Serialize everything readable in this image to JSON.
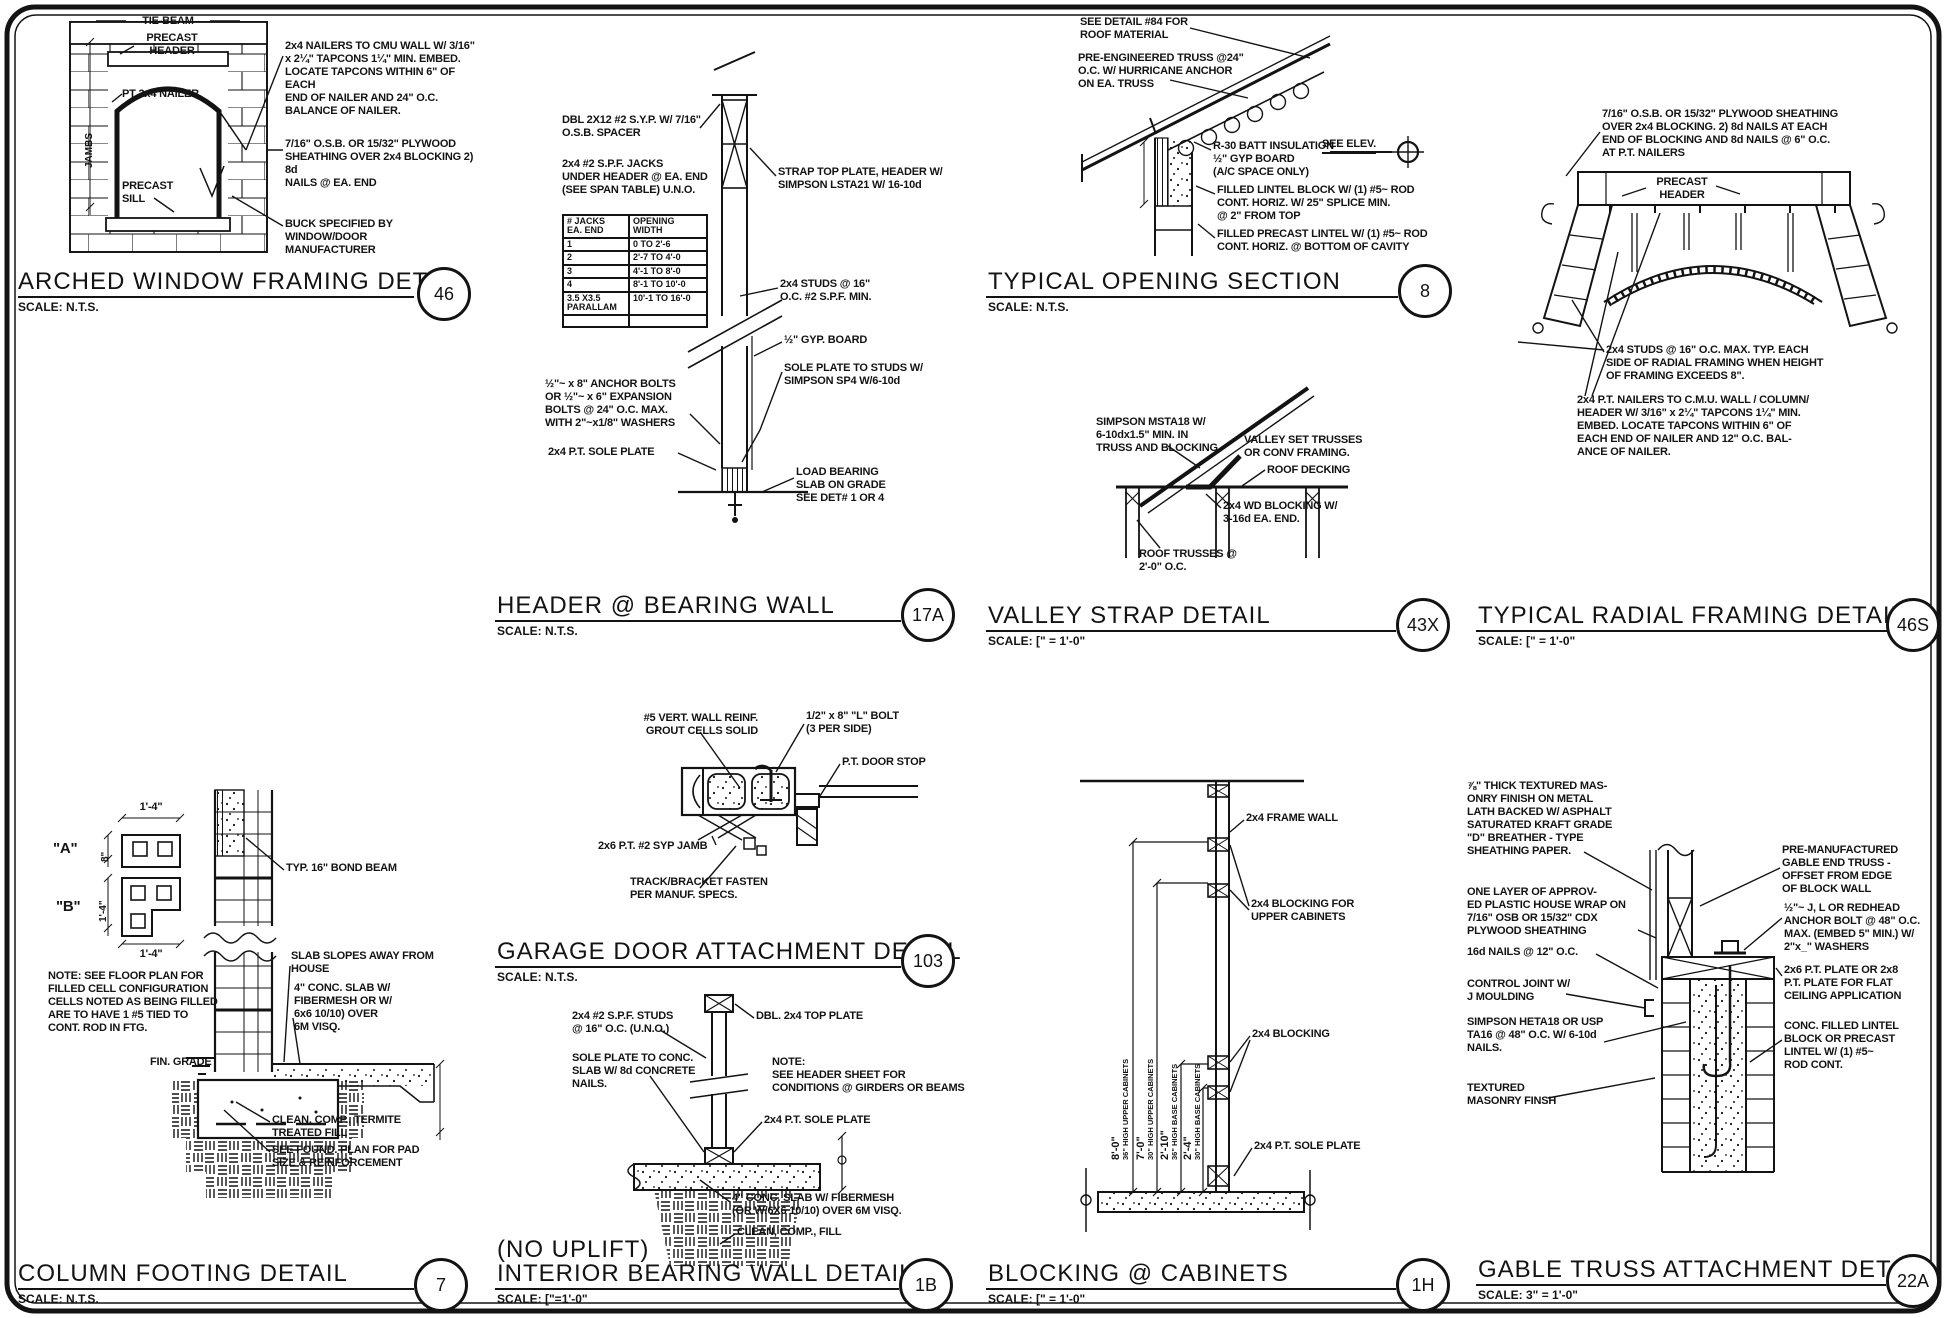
{
  "details": {
    "arched_window": {
      "title": "ARCHED WINDOW FRAMING DETAIL",
      "scale": "SCALE: N.T.S.",
      "num": "46",
      "labels": {
        "tie_beam": "TIE-BEAM",
        "precast_header": "PRECAST\nHEADER",
        "pt_nailer": "PT 2x4 NAILER",
        "precast_sill": "PRECAST\nSILL",
        "jambs": "JAMBS"
      },
      "notes": {
        "nailers": "2x4 NAILERS TO CMU WALL W/ 3/16\"\nx 2¼\" TAPCONS 1¼\" MIN. EMBED.\nLOCATE TAPCONS WITHIN 6\" OF EACH\nEND OF NAILER AND 24\" O.C.\nBALANCE OF NAILER.",
        "sheathing": "7/16\" O.S.B. OR 15/32\" PLYWOOD\nSHEATHING OVER 2x4 BLOCKING 2) 8d\nNAILS @ EA. END",
        "buck": "BUCK SPECIFIED BY WINDOW/DOOR\nMANUFACTURER"
      }
    },
    "header_wall": {
      "title": "HEADER @ BEARING WALL",
      "scale": "SCALE: N.T.S.",
      "num": "17A",
      "notes": {
        "dbl": "DBL 2X12 #2 S.Y.P. W/ 7/16\"\nO.S.B. SPACER",
        "jacks": "2x4 #2 S.P.F. JACKS\nUNDER HEADER @ EA. END\n(SEE SPAN TABLE) U.N.O.",
        "anchor": "½\"~ x 8\" ANCHOR BOLTS\nOR ½\"~ x 6\" EXPANSION\nBOLTS @ 24\" O.C. MAX.\nWITH 2\"~x1/8\" WASHERS",
        "sole": "2x4 P.T. SOLE PLATE",
        "strap": "STRAP TOP PLATE, HEADER W/\nSIMPSON LSTA21 W/ 16-10d",
        "studs": "2x4 STUDS @ 16\"\nO.C. #2 S.P.F. MIN.",
        "gyp": "½\" GYP. BOARD",
        "sp4": "SOLE PLATE TO STUDS W/\nSIMPSON SP4 W/6-10d",
        "slab": "LOAD BEARING\nSLAB ON GRADE\nSEE DET# 1 OR 4"
      },
      "table": {
        "h0": "# JACKS\nEA. END",
        "h1": "OPENING\nWIDTH",
        "rows": [
          [
            "1",
            "0 TO 2'-6"
          ],
          [
            "2",
            "2'-7 TO 4'-0"
          ],
          [
            "3",
            "4'-1 TO 8'-0"
          ],
          [
            "4",
            "8'-1 TO 10'-0"
          ],
          [
            "3.5 X3.5\nPARALLAM",
            "10'-1 TO 16'-0"
          ]
        ]
      }
    },
    "opening_section": {
      "title": "TYPICAL OPENING SECTION",
      "scale": "SCALE: N.T.S.",
      "num": "8",
      "notes": {
        "roof": "SEE DETAIL #84 FOR\nROOF MATERIAL",
        "truss": "PRE-ENGINEERED TRUSS @24\"\nO.C. W/ HURRICANE ANCHOR\nON EA. TRUSS",
        "see_elev": "SEE ELEV.",
        "batt": "R-30 BATT INSULATION\n½\" GYP BOARD\n(A/C SPACE ONLY)",
        "lintel": "FILLED LINTEL BLOCK W/ (1) #5~ ROD\nCONT. HORIZ. W/ 25\" SPLICE MIN.\n@ 2\" FROM TOP",
        "precast": "FILLED PRECAST LINTEL W/ (1) #5~ ROD\nCONT. HORIZ. @ BOTTOM OF CAVITY"
      }
    },
    "valley_strap": {
      "title": "VALLEY STRAP DETAIL",
      "scale": "SCALE: [\" = 1'-0\"",
      "num": "43X",
      "notes": {
        "simpson": "SIMPSON MSTA18 W/\n6-10dx1.5\" MIN. IN\nTRUSS AND BLOCKING",
        "set": "VALLEY SET TRUSSES\nOR CONV FRAMING.",
        "decking": "ROOF DECKING",
        "blocking": "2x4 WD BLOCKING W/\n3-16d EA. END.",
        "trusses": "ROOF TRUSSES @\n2'-0\" O.C."
      }
    },
    "radial": {
      "title": "TYPICAL RADIAL FRAMING DETAIL",
      "scale": "SCALE: [\" = 1'-0\"",
      "num": "46S",
      "notes": {
        "sheathing": "7/16\" O.S.B. OR 15/32\" PLYWOOD SHEATHING\nOVER 2x4 BLOCKING. 2) 8d NAILS AT EACH\nEND OF BLOCKING AND 8d NAILS @ 6\" O.C.\nAT P.T. NAILERS",
        "header": "PRECAST\nHEADER",
        "studs": "2x4 STUDS @ 16\" O.C. MAX. TYP. EACH\nSIDE OF RADIAL FRAMING WHEN HEIGHT\nOF FRAMING EXCEEDS 8\".",
        "nailers": "2x4 P.T. NAILERS TO C.M.U. WALL / COLUMN/\nHEADER W/ 3/16\" x 2¼\" TAPCONS 1¼\" MIN.\nEMBED. LOCATE TAPCONS WITHIN 6\" OF\nEACH END OF NAILER AND 12\" O.C. BAL-\nANCE OF NAILER."
      }
    },
    "column_footing": {
      "title": "COLUMN FOOTING DETAIL",
      "scale": "SCALE: N.T.S.",
      "num": "7",
      "labels": {
        "a": "\"A\"",
        "b": "\"B\"",
        "dim_a_w": "1'-4\"",
        "dim_a_h": "8\"",
        "dim_b_h": "1'-4\"",
        "dim_b_w": "1'-4\"",
        "grade": "FIN. GRADE"
      },
      "notes": {
        "note": "NOTE: SEE FLOOR PLAN FOR\nFILLED CELL CONFIGURATION\nCELLS NOTED AS BEING FILLED\nARE TO HAVE 1 #5 TIED TO\nCONT. ROD IN FTG.",
        "bond": "TYP. 16\" BOND BEAM",
        "slopes": "SLAB SLOPES AWAY FROM\nHOUSE",
        "slab": "4\" CONC. SLAB W/\nFIBERMESH OR W/\n6x6 10/10) OVER\n6M VISQ.",
        "termite": "CLEAN, COMP., TERMITE\nTREATED FILL",
        "found": "SEE FOUND. PLAN FOR PAD\nSIZE & REINFORCEMENT"
      }
    },
    "garage_door": {
      "title": "GARAGE DOOR ATTACHMENT DETAIL",
      "scale": "SCALE: N.T.S.",
      "num": "103",
      "notes": {
        "reinf": "#5 VERT. WALL REINF.\nGROUT CELLS SOLID",
        "bolt": "1/2\" x 8\" \"L\" BOLT\n(3 PER SIDE)",
        "stop": "P.T. DOOR STOP",
        "jamb": "2x6 P.T. #2 SYP JAMB",
        "track": "TRACK/BRACKET FASTEN\nPER MANUF. SPECS."
      }
    },
    "interior_wall": {
      "prefix": "(NO UPLIFT)",
      "title": "INTERIOR BEARING WALL DETAIL",
      "scale": "SCALE: [\"=1'-0\"",
      "num": "1B",
      "notes": {
        "studs": "2x4 #2 S.P.F. STUDS\n@ 16\" O.C. (U.N.O.)",
        "top": "DBL. 2x4 TOP PLATE",
        "sole_note": "SOLE PLATE TO CONC.\nSLAB W/ 8d CONCRETE\nNAILS.",
        "note": "NOTE:\nSEE HEADER SHEET FOR\nCONDITIONS @ GIRDERS OR BEAMS",
        "pt_sole": "2x4 P.T. SOLE PLATE",
        "slab": "4\" CONC. SLAB W/ FIBERMESH\n(OR W/6X6 10/10) OVER 6M VISQ.",
        "fill": "CLEAN, COMP., FILL"
      }
    },
    "cabinets": {
      "title": "BLOCKING @ CABINETS",
      "scale": "SCALE: [\" = 1'-0\"",
      "num": "1H",
      "notes": {
        "frame": "2x4 FRAME WALL",
        "upper": "2x4 BLOCKING FOR\nUPPER CABINETS",
        "blocking": "2x4 BLOCKING",
        "sole": "2x4 P.T. SOLE PLATE"
      },
      "dims": [
        {
          "value": "8'-0\"",
          "label": "36\" HIGH UPPER CABINETS"
        },
        {
          "value": "7'-0\"",
          "label": "30\" HIGH UPPER CABINETS"
        },
        {
          "value": "2'-10\"",
          "label": "36\" HIGH BASE CABINETS"
        },
        {
          "value": "2'-4\"",
          "label": "30\" HIGH BASE CABINETS"
        }
      ]
    },
    "gable": {
      "title": "GABLE TRUSS ATTACHMENT DETAIL",
      "scale": "SCALE: 3\" = 1'-0\"",
      "num": "22A",
      "notes": {
        "masonry": "⅞\" THICK TEXTURED MAS-\nONRY FINISH ON METAL\nLATH BACKED W/ ASPHALT\nSATURATED KRAFT GRADE\n\"D\" BREATHER - TYPE\nSHEATHING PAPER.",
        "wrap": "ONE LAYER OF APPROV-\nED PLASTIC HOUSE WRAP ON\n7/16\" OSB OR 15/32\" CDX\nPLYWOOD SHEATHING",
        "nails": "16d NAILS @ 12\" O.C.",
        "joint": "CONTROL JOINT W/\nJ MOULDING",
        "simpson": "SIMPSON HETA18 OR USP\nTA16 @ 48\" O.C. W/ 6-10d\nNAILS.",
        "textured": "TEXTURED\nMASONRY FINSH",
        "truss": "PRE-MANUFACTURED\nGABLE END TRUSS -\nOFFSET FROM EDGE\nOF BLOCK WALL",
        "anchor": "½\"~ J, L OR REDHEAD\nANCHOR BOLT @ 48\" O.C.\nMAX. (EMBED 5\" MIN.) W/\n2\"x_\" WASHERS",
        "plate": "2x6 P.T. PLATE OR 2x8\nP.T. PLATE FOR FLAT\nCEILING APPLICATION",
        "lintel": "CONC. FILLED LINTEL\nBLOCK OR PRECAST\nLINTEL W/ (1) #5~\nROD CONT."
      }
    }
  }
}
